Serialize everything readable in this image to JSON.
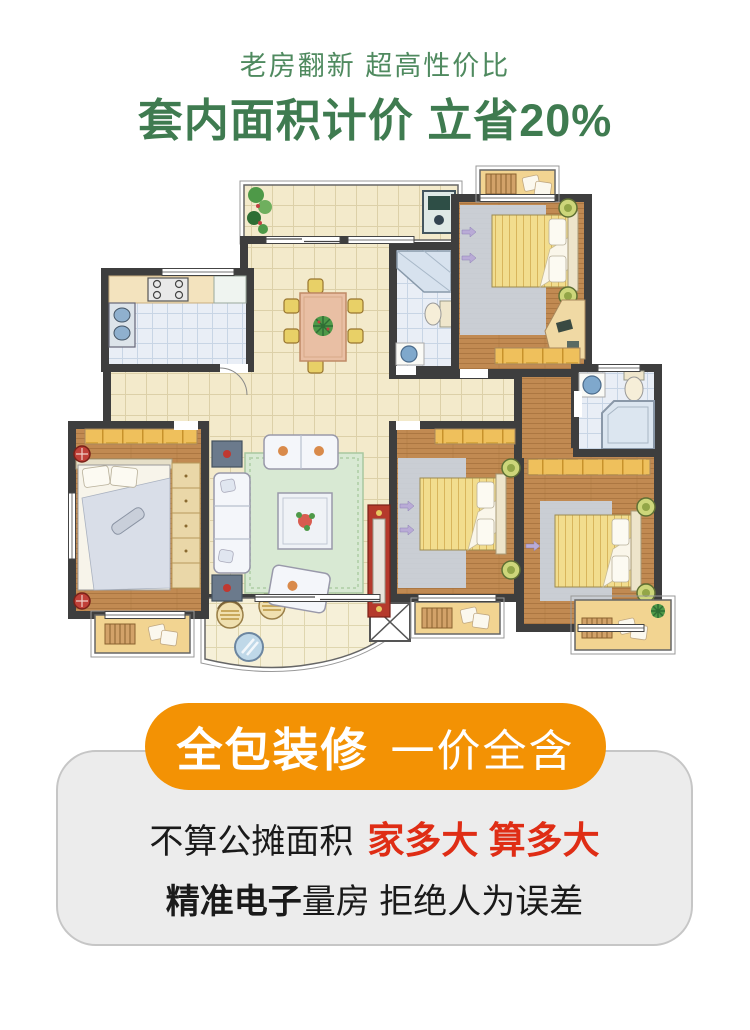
{
  "header": {
    "subtitle": "老房翻新 超高性价比",
    "title": "套内面积计价 立省20%"
  },
  "banner": {
    "label_bold": "全包装修",
    "label_regular": "一价全含"
  },
  "card": {
    "line1_prefix": "不算公摊面积",
    "line1_highlight": "家多大 算多大",
    "line2_bold": "精准电子",
    "line2_rest": "量房 拒绝人为误差"
  },
  "colors": {
    "subtitle_green": "#4F8A5F",
    "title_green": "#3F7B50",
    "banner_orange": "#F39204",
    "banner_text": "#FFFFFF",
    "card_bg": "#ECECEC",
    "card_border": "#C6C6C6",
    "card_text": "#1A1A1A",
    "highlight_red": "#DF2D15",
    "wall": "#3E3E3E",
    "floor_beige": "#F3EACB",
    "floor_beige_line": "#DCD0A8",
    "floor_wood": "#C18A52",
    "floor_wood_line": "#A5713C",
    "floor_tile_blue": "#E9EEF6",
    "floor_tile_blue_line": "#C8D5E5",
    "balcony_tan": "#F2D491",
    "wardrobe_yellow": "#EFC05C",
    "bed_yellow": "#F2DD8E",
    "rug_gray": "#CBD5E2",
    "rug_green": "#D8E9D3",
    "tv_red": "#B5392C",
    "plant_green": "#4E9948"
  }
}
